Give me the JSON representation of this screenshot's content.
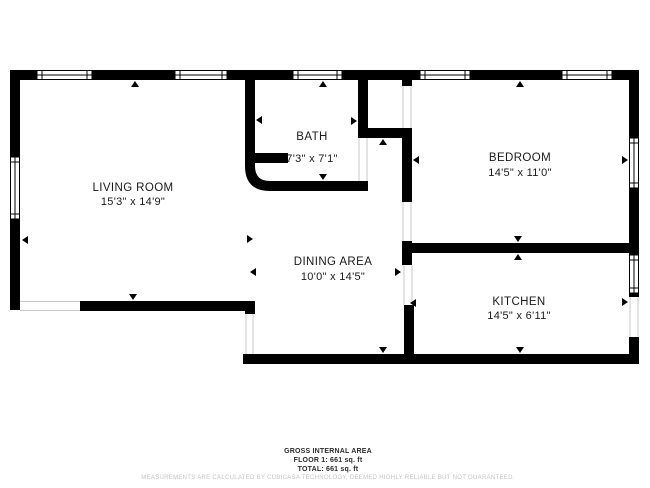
{
  "plan": {
    "rooms": [
      {
        "id": "living-room",
        "name": "LIVING ROOM",
        "dims": "15'3\" x 14'9\""
      },
      {
        "id": "bath",
        "name": "BATH",
        "dims": "7'3\" x 7'1\""
      },
      {
        "id": "dining-area",
        "name": "DINING AREA",
        "dims": "10'0\" x 14'5\""
      },
      {
        "id": "bedroom",
        "name": "BEDROOM",
        "dims": "14'5\" x 11'0\""
      },
      {
        "id": "kitchen",
        "name": "KITCHEN",
        "dims": "14'5\" x 6'11\""
      }
    ]
  },
  "footer": {
    "area_title": "GROSS INTERNAL AREA",
    "floor_line": "FLOOR 1: 661 sq. ft",
    "total_line": "TOTAL: 661 sq. ft",
    "disclaimer": "MEASUREMENTS ARE CALCULATED BY CUBICASA TECHNOLOGY, DEEMED HIGHLY RELIABLE BUT NOT GUARANTEED."
  },
  "colors": {
    "wall": "#000000",
    "background": "#ffffff",
    "door_jamb": "#c9c9c9",
    "label_text": "#1a1a1a",
    "footer_text": "#2b2b2b",
    "disclaimer_text": "#c4c4c4"
  }
}
